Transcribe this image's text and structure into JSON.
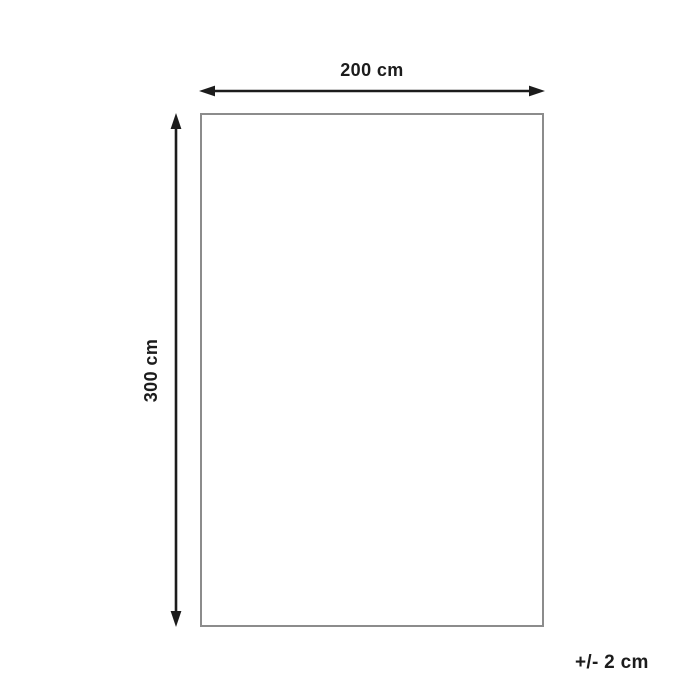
{
  "diagram": {
    "type": "dimension-diagram",
    "width_label": "200 cm",
    "height_label": "300 cm",
    "tolerance_label": "+/- 2 cm",
    "colors": {
      "arrow": "#1c1c1c",
      "text": "#1c1c1c",
      "rectangle_border": "#8c8c8c",
      "background": "#ffffff"
    }
  }
}
